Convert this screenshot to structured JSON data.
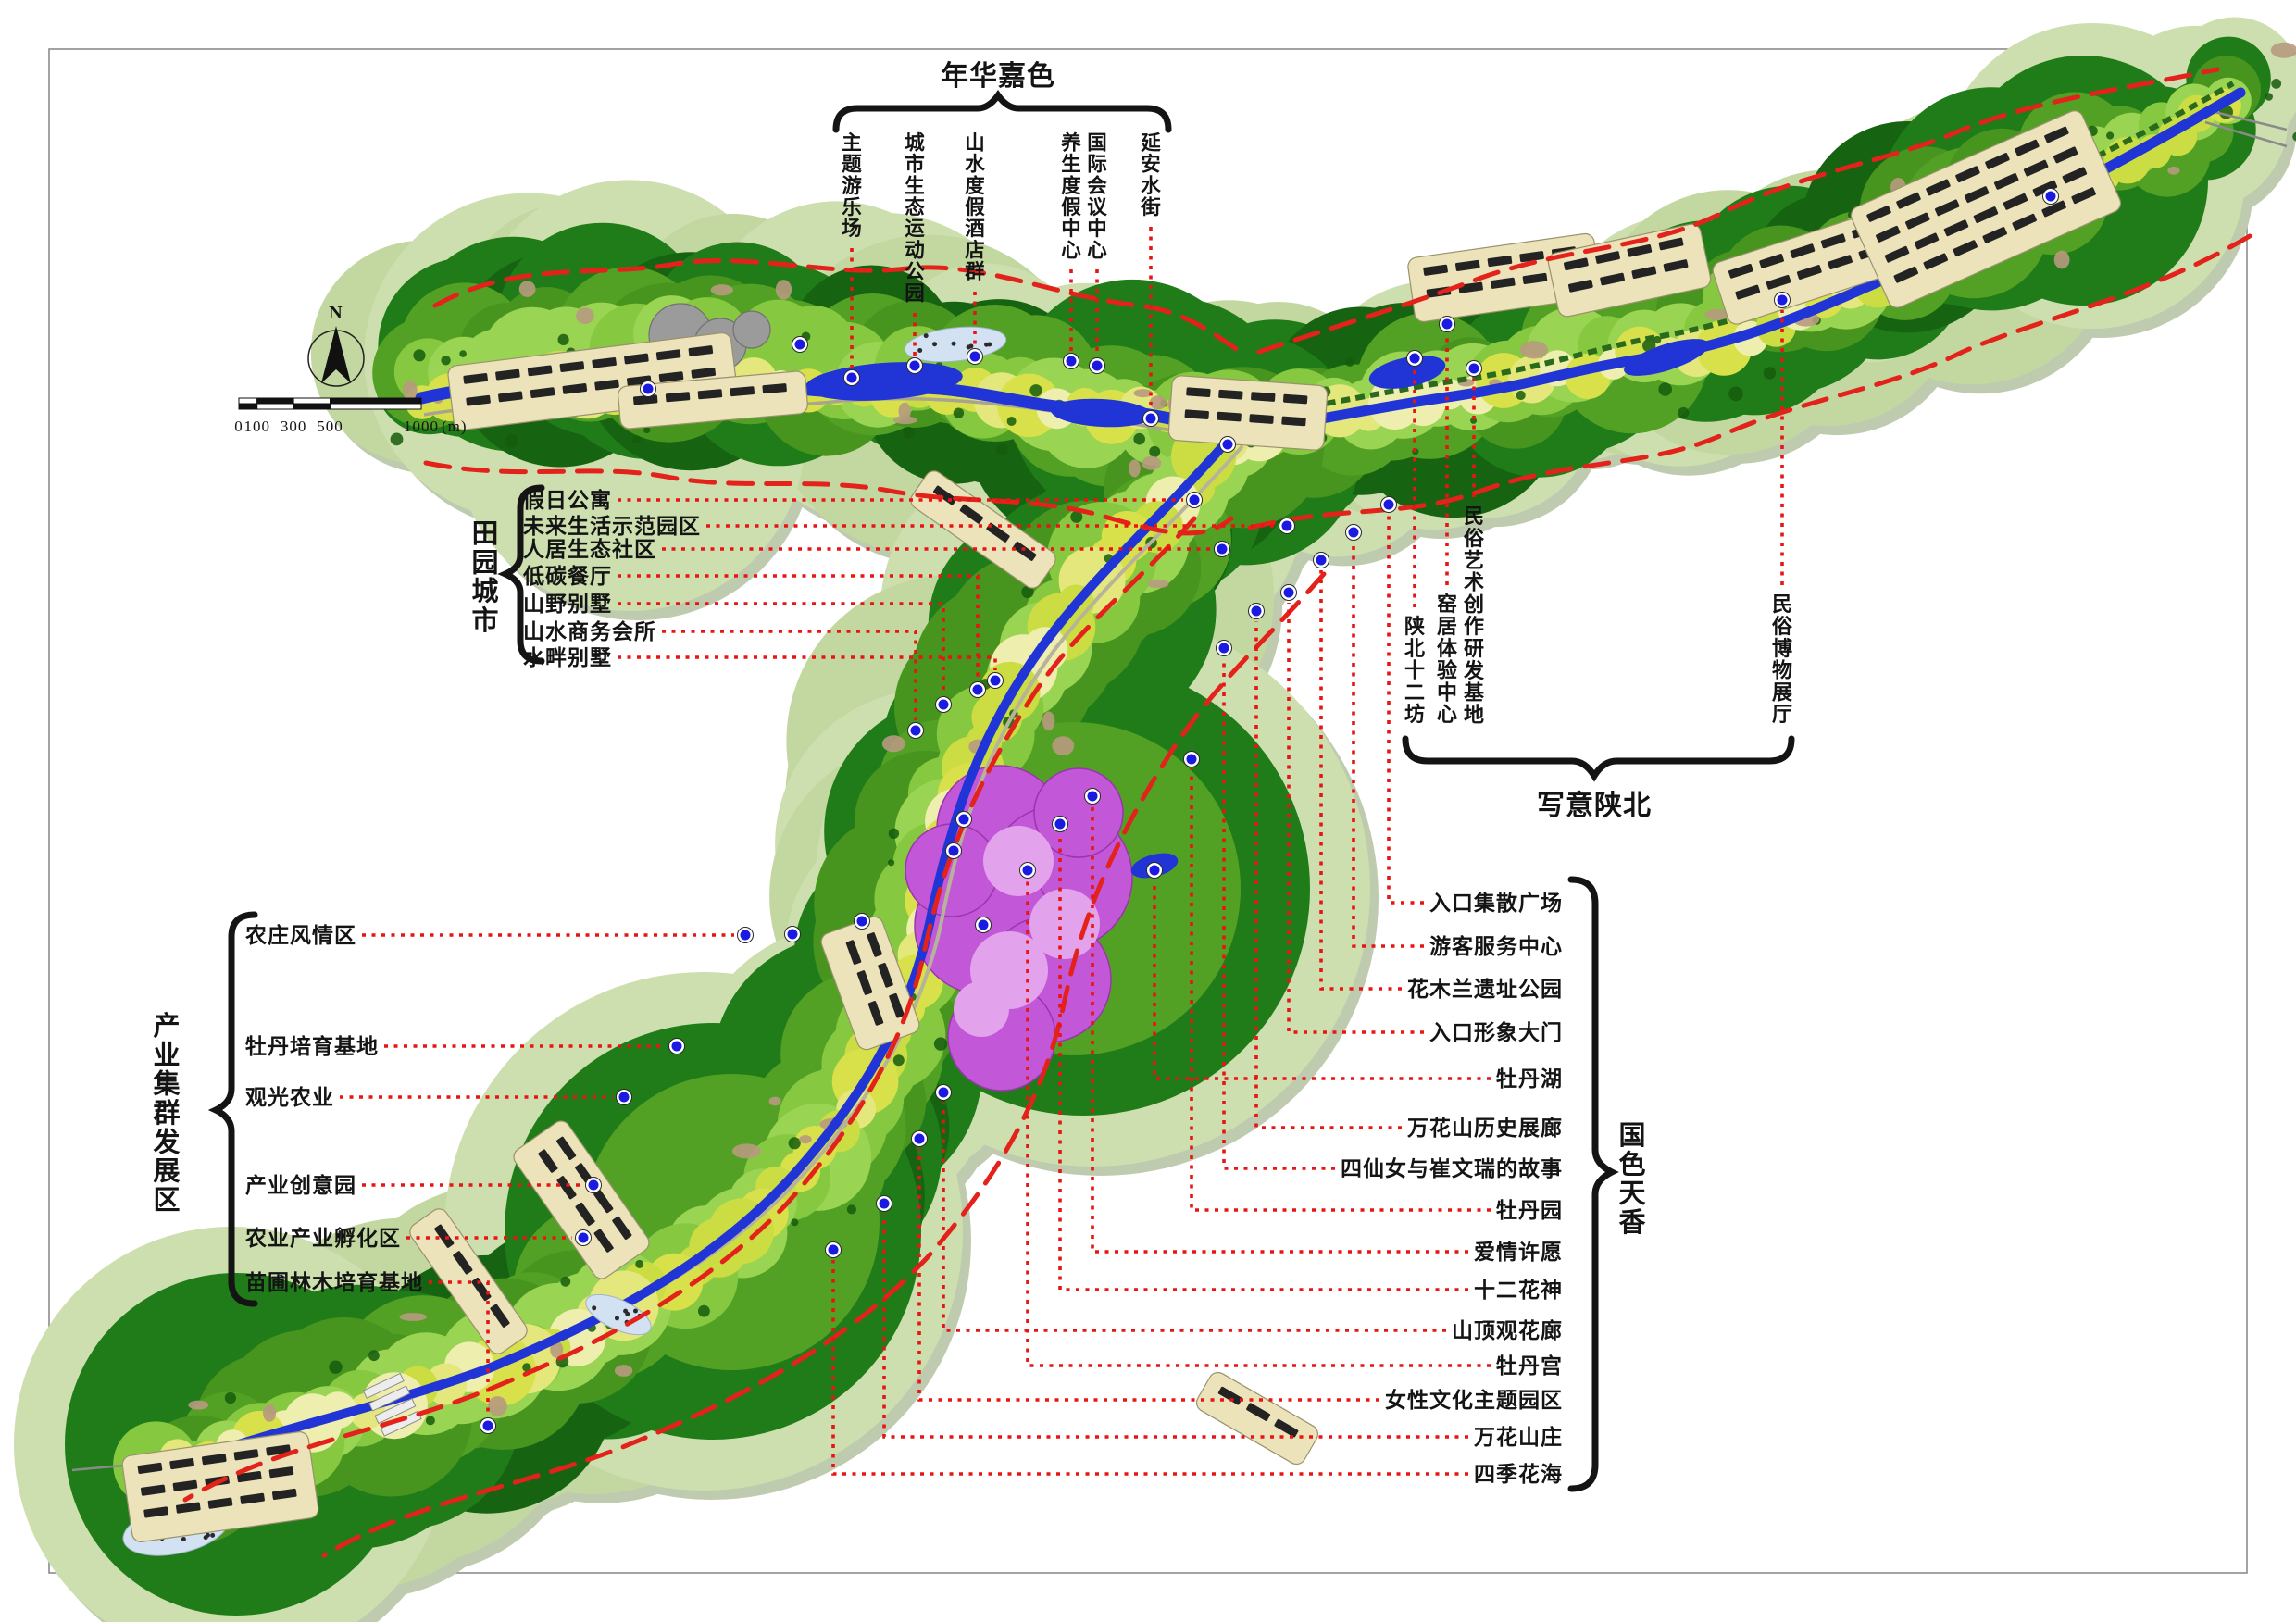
{
  "page": {
    "background": "#ffffff",
    "frame_color": "#8c8c8c"
  },
  "compass": {
    "label": "N"
  },
  "scale_bar": {
    "ticks": [
      "0",
      "100",
      "300",
      "500",
      "1000"
    ],
    "unit": "(m)"
  },
  "legend_groups": {
    "nianhua": {
      "title": "年华嘉色",
      "labels": [
        "主题游乐场",
        "城市生态运动公园",
        "山水度假酒店群",
        "养生度假中心",
        "国际会议中心",
        "延安水街"
      ]
    },
    "tianyuan": {
      "title": "田园城市",
      "labels": [
        "假日公寓",
        "未来生活示范园区",
        "人居生态社区",
        "低碳餐厅",
        "山野别墅",
        "山水商务会所",
        "水畔别墅"
      ]
    },
    "xieyi": {
      "title": "写意陕北",
      "labels": [
        "陕北十二坊",
        "窑居体验中心",
        "民俗艺术创作研发基地",
        "民俗博物展厅"
      ]
    },
    "chanye": {
      "title": "产业集群发展区",
      "labels": [
        "农庄风情区",
        "牡丹培育基地",
        "观光农业",
        "产业创意园",
        "农业产业孵化区",
        "苗圃林木培育基地"
      ]
    },
    "guose": {
      "title": "国色天香",
      "labels": [
        "入口集散广场",
        "游客服务中心",
        "花木兰遗址公园",
        "入口形象大门",
        "牡丹湖",
        "万花山历史展廊",
        "四仙女与崔文瑞的故事",
        "牡丹园",
        "爱情许愿",
        "十二花神",
        "山顶观花廊",
        "牡丹宫",
        "女性文化主题园区",
        "万花山庄",
        "四季花海"
      ]
    }
  },
  "map_colors": {
    "outer_green": "#cddfae",
    "outer_green2": "#c3d8a0",
    "shadow_green": "#bfcbae",
    "forest_green": "#1f7c18",
    "forest_green2": "#166312",
    "mid_green": "#52a124",
    "mid_green2": "#47941f",
    "valley_green": "#86c940",
    "valley_green2": "#9ad453",
    "field_yellow": "#d9e14a",
    "field_yellow2": "#cbdd42",
    "field_pale": "#eeeeae",
    "field_mid": "#e4e87c",
    "river_blue": "#2135d6",
    "pond_pale": "#d3e2f2",
    "boundary_red": "#e3231b",
    "leader_red": "#e81512",
    "peony_pink": "#c257d8",
    "peony_pink_light": "#e2a2ec",
    "development_beige": "#ece3bb",
    "building_black": "#232323",
    "marker_blue": "#1a1ae0",
    "rock_gray": "#9b9b9b",
    "tree_dark": "#155c0d",
    "soil_brown": "#b79a7e"
  }
}
